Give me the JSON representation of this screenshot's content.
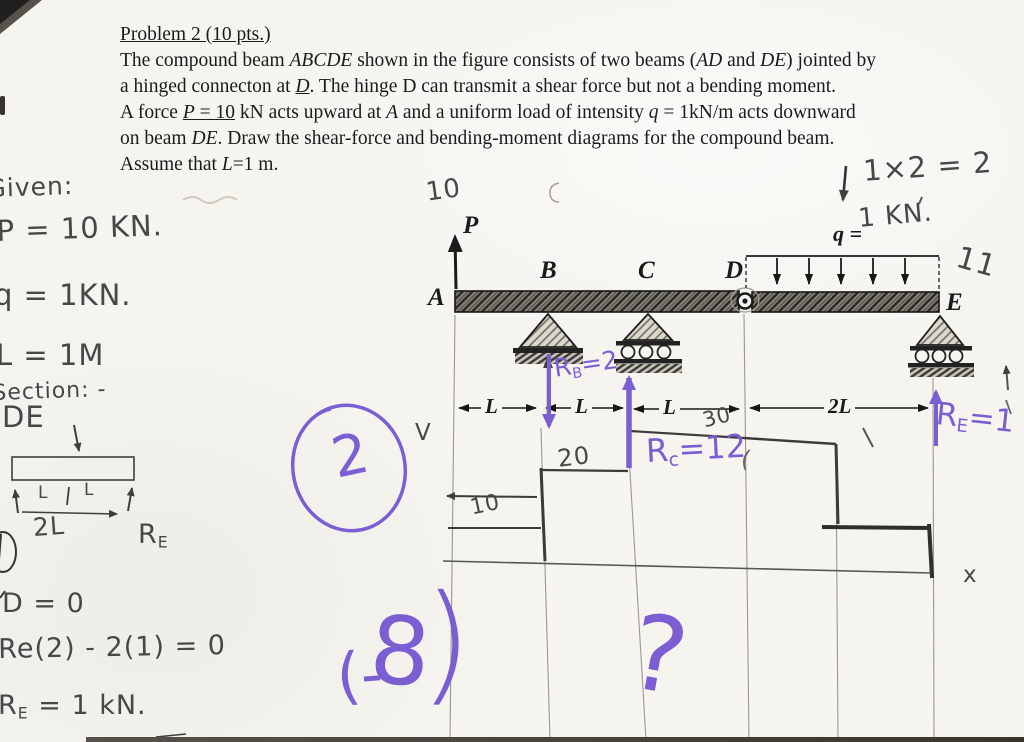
{
  "colors": {
    "paper": "#f5f4ef",
    "ink": "#1b1b1b",
    "pencil": "#474747",
    "purple": "#7a5ed2"
  },
  "printed": {
    "title": "Problem 2 (10 pts.)",
    "lines": [
      [
        {
          "t": "The compound beam "
        },
        {
          "t": "ABCDE",
          "i": 1
        },
        {
          "t": " shown in the figure consists of two beams ("
        },
        {
          "t": "AD",
          "i": 1
        },
        {
          "t": " and "
        },
        {
          "t": "DE",
          "i": 1
        },
        {
          "t": ") jointed by"
        }
      ],
      [
        {
          "t": "a hinged connecton at "
        },
        {
          "t": "D",
          "i": 1,
          "u": 1
        },
        {
          "t": ". The hinge D can transmit a shear force but not a bending moment."
        }
      ],
      [
        {
          "t": "A force "
        },
        {
          "t": "P",
          "i": 1,
          "u": 1
        },
        {
          "t": " = 10",
          "u": 1
        },
        {
          "t": " kN acts upward at "
        },
        {
          "t": "A",
          "i": 1
        },
        {
          "t": " and a uniform load of intensity "
        },
        {
          "t": "q",
          "i": 1
        },
        {
          "t": " = 1kN/m acts downward"
        }
      ],
      [
        {
          "t": "on beam "
        },
        {
          "t": "DE",
          "i": 1
        },
        {
          "t": ". Draw the shear-force and bending-moment diagrams for the compound beam."
        }
      ],
      [
        {
          "t": "Assume that "
        },
        {
          "t": "L",
          "i": 1
        },
        {
          "t": "=1 m."
        }
      ]
    ],
    "figure": {
      "A": "A",
      "B": "B",
      "C": "C",
      "D": "D",
      "E": "E",
      "P": "P",
      "q": "q ="
    },
    "dims": [
      "L",
      "L",
      "L",
      "2L"
    ]
  },
  "pencil": {
    "given": "Given:",
    "p_eq": "P = 10 KN.",
    "q_eq": "q = 1KN.",
    "l_eq": "L = 1M",
    "section": "Section: -",
    "de": "DE",
    "sketch": {
      "l_left": "L",
      "l_right": "L",
      "two_l": "2L",
      "re_pre": "R",
      "re_sub": "E"
    },
    "moment_eq": "D = 0",
    "re_calc": "Re(2) - 2(1) = 0",
    "re_val_pre": "R",
    "re_val_sub": "E",
    "re_val_post": " = 1 kN.",
    "p_val": "10",
    "q_val": "1 KN.",
    "calc": "1×2 = 2",
    "eleven": "11",
    "v_axis": "V",
    "x_axis": "x",
    "v10": "10",
    "v20": "20",
    "v30": "30"
  },
  "purple": {
    "rb": {
      "pre": "R",
      "sub": "B",
      "post": "=2"
    },
    "rc": {
      "pre": "R",
      "sub": "c",
      "post": "=12"
    },
    "re": {
      "pre": "R",
      "sub": "E",
      "post": "=1"
    },
    "circled_num": "2",
    "neg8_open": "(-",
    "neg8_digit": "8",
    "neg8_close": ")",
    "question": "?",
    "stray_paren": "("
  }
}
